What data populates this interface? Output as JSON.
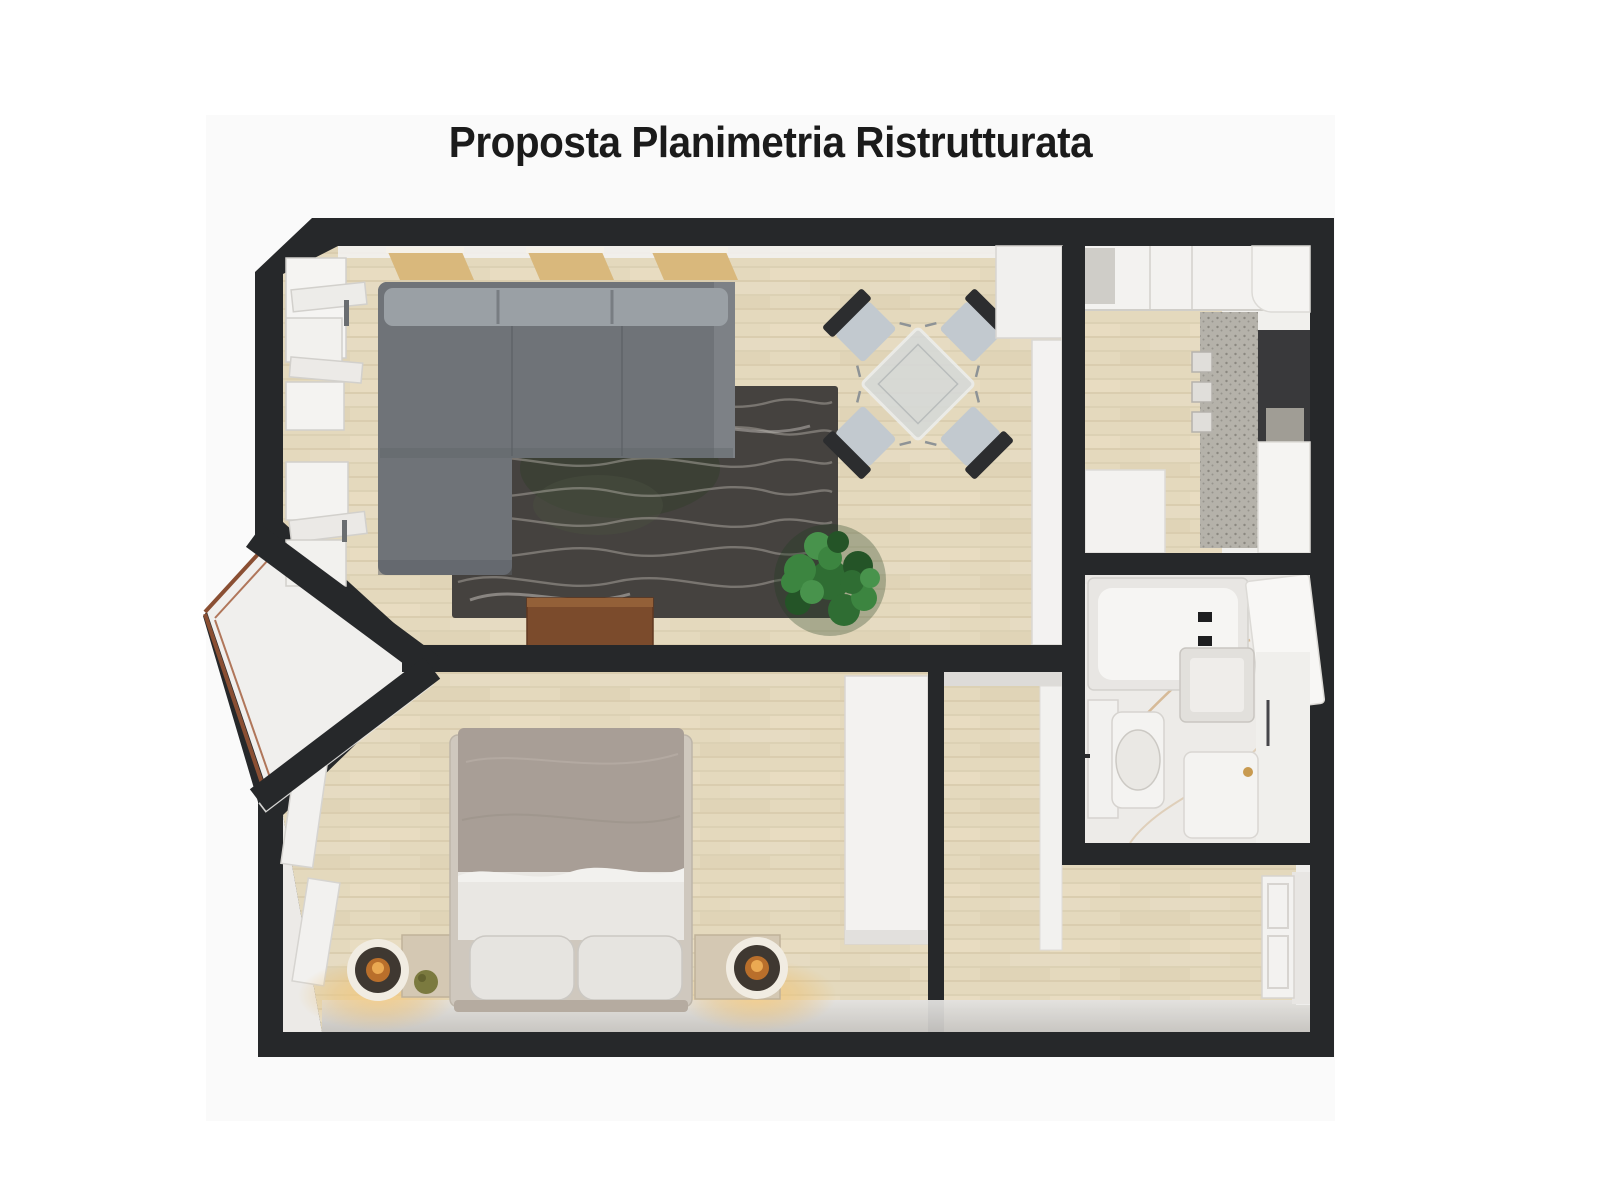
{
  "image": {
    "title": "Proposta Planimetria Ristrutturata"
  },
  "colors": {
    "page_bg": "#ffffff",
    "photo_bg": "#fafafa",
    "title_text": "#1b1b1b",
    "wall": "#26282a",
    "wood_floor": "#e4d9bd",
    "white_room": "#f1f0ed",
    "rug": "#45423f",
    "rug_pattern": "#b7b3ae",
    "sofa": "#6f7378",
    "sofa_back": "#9aa0a5",
    "duvet": "#a89e96",
    "sheet": "#e9e7e3",
    "nightstand": "#d4c8b3",
    "lamp_glow": "#e8b25c",
    "plant": "#35773a",
    "sideboard": "#7b4b2c",
    "copper_trim": "#8a4f33",
    "marble_vein": "#c79a63",
    "counter_speckle": "#b5b2aa"
  },
  "floorplan": {
    "type": "3d-top-down-render",
    "rooms": [
      {
        "name": "living-room",
        "furniture": [
          "l-shaped-gray-sofa",
          "wavy-pattern-rug",
          "dining-table-with-four-chairs",
          "wooden-sideboard",
          "potted-plant",
          "wall-shelves-above-sofa",
          "ornate-white-built-ins",
          "tall-white-wardrobe"
        ]
      },
      {
        "name": "kitchen",
        "furniture": [
          "white-cabinets",
          "speckled-countertop",
          "cooktop",
          "fridge-column",
          "dark-counter-recess"
        ]
      },
      {
        "name": "bathroom",
        "furniture": [
          "bathtub",
          "toilet",
          "sink-basin",
          "vanity-cabinet",
          "open-door-leaf"
        ]
      },
      {
        "name": "bedroom",
        "furniture": [
          "double-bed",
          "nightstand-left",
          "nightstand-right",
          "ring-lamp-left",
          "ring-lamp-right",
          "white-wardrobe",
          "wall-moldings"
        ]
      },
      {
        "name": "hallway",
        "furniture": [
          "paneled-entry-door",
          "corridor-cabinet"
        ]
      },
      {
        "name": "entrance-vestibule",
        "furniture": [
          "copper-trimmed-glass-doors"
        ]
      }
    ]
  }
}
